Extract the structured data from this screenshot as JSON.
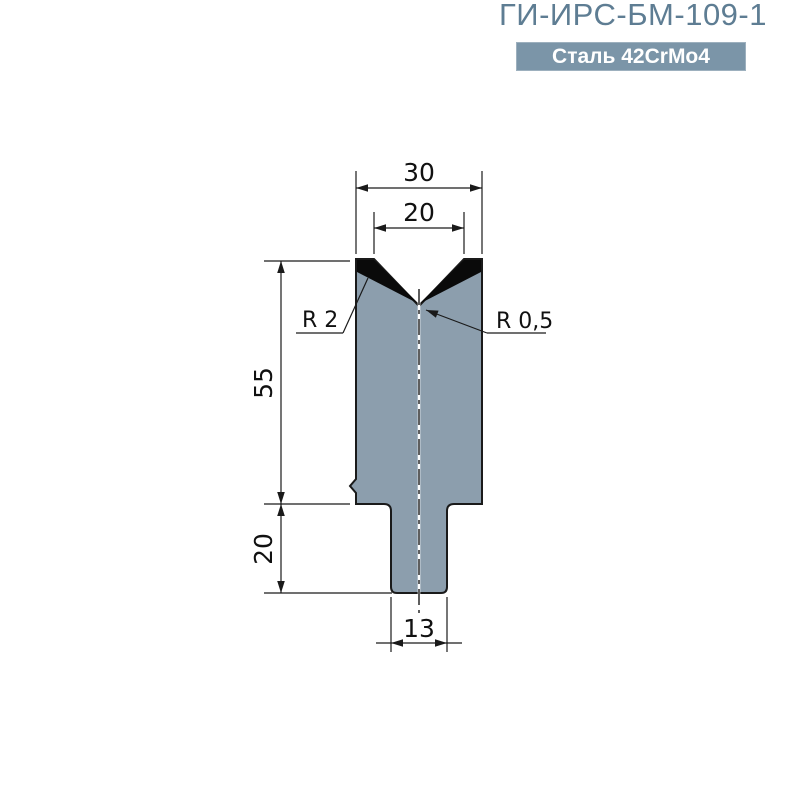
{
  "header": {
    "title": "ГИ-ИРС-БМ-109-1",
    "material_badge": "Сталь 42CrMo4"
  },
  "colors": {
    "accent": "#5e7d93",
    "badge_bg": "#7b95a8",
    "badge_text": "#ffffff",
    "die_fill": "#8c9ead",
    "hardened_zone": "#0a0a0a",
    "line": "#1a1a1a"
  },
  "drawing": {
    "type": "press-brake-die-cross-section",
    "dimensions": {
      "overall_width": "30",
      "v_opening_width": "20",
      "body_height": "55",
      "tang_height": "20",
      "tang_width": "13",
      "shoulder_radius": "R 2",
      "v_bottom_radius": "R 0,5"
    }
  }
}
